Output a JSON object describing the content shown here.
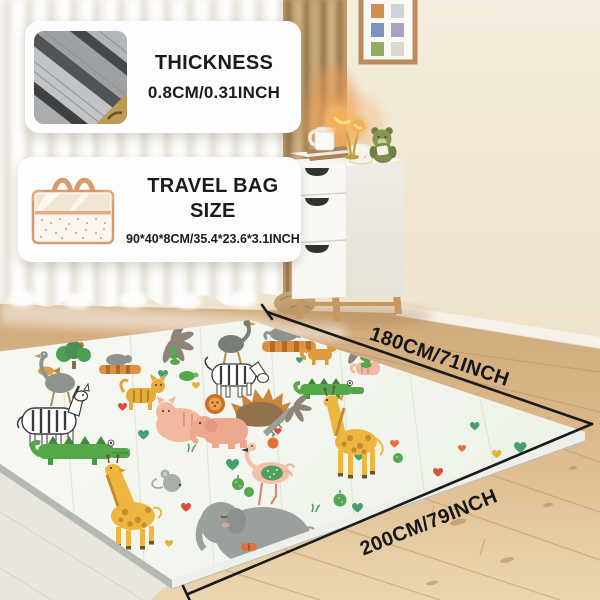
{
  "product_cards": {
    "thickness": {
      "title": "THICKNESS",
      "value": "0.8CM/0.31INCH",
      "image": "mat-edge-closeup-photo"
    },
    "travel_bag": {
      "title": "TRAVEL BAG SIZE",
      "value": "90*40*8CM/35.4*23.6*3.1INCH",
      "image": "travel-bag-illustration"
    }
  },
  "dimension_labels": {
    "width": "180CM/71INCH",
    "length": "200CM/79INCH"
  },
  "scene": {
    "mat_background": "#f5f8f2",
    "mat_animals": [
      "crocodile",
      "giraffe",
      "elephant",
      "pink-elephant",
      "flamingo",
      "zebra",
      "ostrich",
      "lion",
      "hedgehog",
      "tiger",
      "peach-cat",
      "mouse",
      "turtle",
      "fish",
      "palm-tree",
      "fern",
      "hearts",
      "apples",
      "butterfly"
    ],
    "room_items": [
      "sheer-curtain",
      "brown-curtain",
      "gallery-frame",
      "white-dresser",
      "double-table-lamp",
      "teddy-bear",
      "mug",
      "book",
      "basket",
      "oak-wood-floor",
      "baseboard"
    ],
    "colors": {
      "wall": "#f1e8d6",
      "floor": "#dcbb8f",
      "dimension_line": "#1a1a1a",
      "card_background": "#fdfdfd",
      "card_text": "#1c1c1c",
      "heart_green": "#45a06e",
      "heart_orange": "#e2713a",
      "heart_red": "#d94f3d",
      "heart_yellow": "#e6b23b",
      "giraffe_yellow": "#ecb63f",
      "crocodile_green": "#55a74a",
      "elephant_gray": "#9aa09b",
      "flamingo_pink": "#f4c2ab",
      "bag_trim": "#d79a6e"
    }
  }
}
